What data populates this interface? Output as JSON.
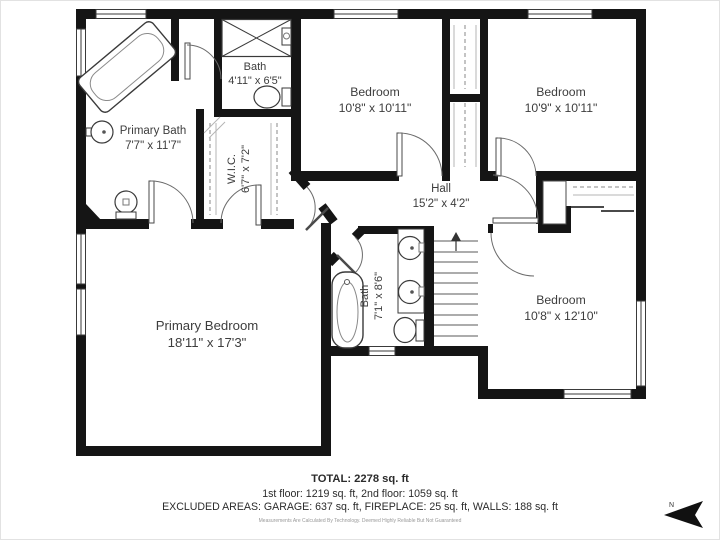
{
  "rooms": {
    "primary_bath": {
      "name": "Primary Bath",
      "dims": "7'7\" x 11'7\""
    },
    "bath_upper": {
      "name": "Bath",
      "dims": "4'11\" x 6'5\""
    },
    "wic": {
      "name": "W.I.C.",
      "dims": "6'7\" x 7'2\""
    },
    "bedroom_a": {
      "name": "Bedroom",
      "dims": "10'8\" x 10'11\""
    },
    "bedroom_b": {
      "name": "Bedroom",
      "dims": "10'9\" x 10'11\""
    },
    "hall": {
      "name": "Hall",
      "dims": "15'2\" x 4'2\""
    },
    "bath_lower": {
      "name": "Bath",
      "dims": "7'1\" x 8'6\""
    },
    "primary_bedroom": {
      "name": "Primary Bedroom",
      "dims": "18'11\" x 17'3\""
    },
    "bedroom_c": {
      "name": "Bedroom",
      "dims": "10'8\" x 12'10\""
    }
  },
  "footer": {
    "total": "TOTAL: 2278 sq. ft",
    "floors": "1st floor: 1219 sq. ft, 2nd floor: 1059 sq. ft",
    "excluded": "EXCLUDED AREAS: GARAGE: 637 sq. ft, FIREPLACE: 25 sq. ft, WALLS: 188 sq. ft",
    "disclaimer": "Measurements Are Calculated By Technology. Deemed Highly Reliable But Not Guaranteed"
  },
  "compass": {
    "north_label": "N"
  },
  "colors": {
    "wall": "#151515",
    "line": "#4a4a4a",
    "text": "#3d3d3d",
    "muted": "#9a9a9a"
  }
}
